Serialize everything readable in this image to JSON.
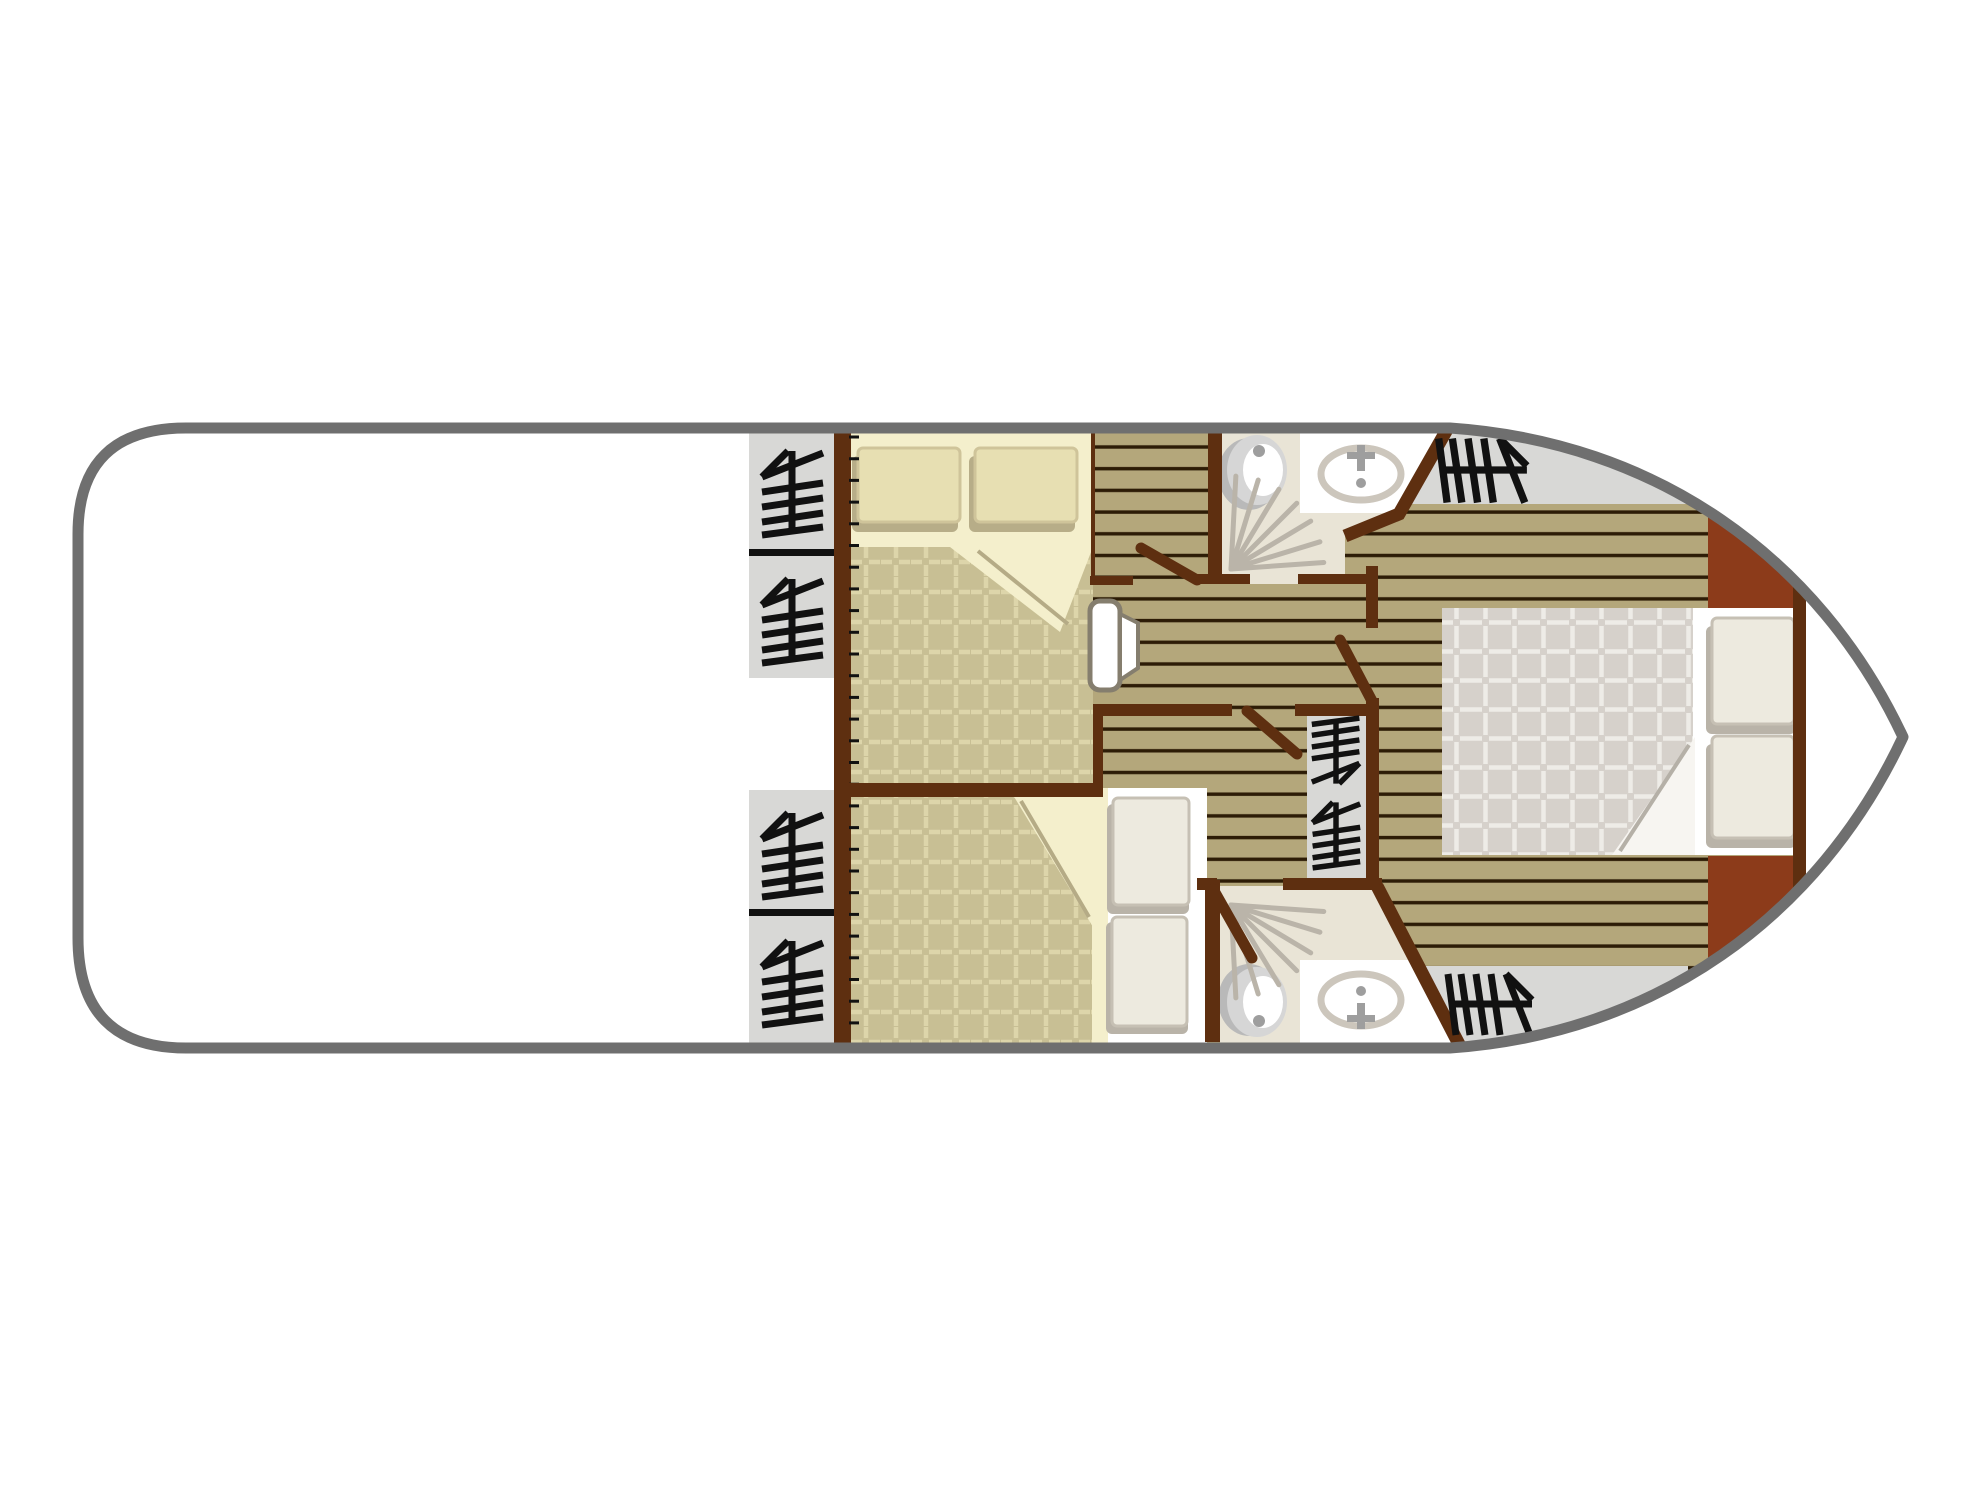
{
  "canvas": {
    "width": 1981,
    "height": 1485,
    "background": "#ffffff"
  },
  "plan": {
    "kind": "boat-deck-floor-plan",
    "rooms": [
      "aft-deck",
      "port-stairs",
      "cabin-top",
      "cabin-bottom",
      "corridor",
      "bathroom-top",
      "bathroom-bottom",
      "center-stair-well",
      "master-bow-cabin"
    ]
  },
  "palette": {
    "white": "#ffffff",
    "hull": "#6f6f6f",
    "wall": "#5e2f10",
    "rust": "#8c3b1a",
    "stairGray": "#d8d8d6",
    "glyph": "#111111",
    "plankBase": "#b4a77b",
    "plankLine": "#2d1c06",
    "cream": "#f4efcc",
    "quiltTan": "#c8bf94",
    "quiltTanLine": "#ddd5aa",
    "quiltGray": "#d6d1cb",
    "quiltGrayLine": "#eeece7",
    "bathFloor": "#e9e4d6",
    "fixture": "#ccc6bc",
    "fixtureDark": "#9e9e9e",
    "toiletShadow": "#b9b9b9",
    "toiletBody": "#d6d6d6",
    "showerRay": "#bab4a9",
    "pillowTan": "#e7dfb2",
    "pillowTanEdge": "#cfc49a",
    "pillowShadowTan": "#b7ad88",
    "pillowWhite": "#edeadf",
    "pillowWhiteEdge": "#c6c0b4",
    "pillowShadowGray": "#b9b3a8",
    "foldLine": "#b5ab86",
    "foldLineGray": "#b5b0a7",
    "doorEdge": "#857e6e"
  },
  "hull": {
    "path": "M1450,428 L186,428 Q78,428 78,534 L78,938 Q78,1048 186,1048 L1450,1048 C1655,1034 1818,918 1903,737 C1818,556 1655,442 1450,428 Z",
    "strokeWidth": 11
  },
  "patterns": [
    {
      "id": "planks",
      "type": "stripes",
      "w": 40,
      "h": 21.7,
      "x": 0,
      "y": 3,
      "base": "$plankBase",
      "line": "$plankLine",
      "lw": 3.4,
      "ly": 10
    },
    {
      "id": "quilt",
      "type": "grid",
      "w": 30,
      "h": 30,
      "x": 851,
      "y": 547,
      "base": "$quiltTan",
      "line": "$quiltTanLine",
      "lw": 4.5,
      "dash": "11 7"
    },
    {
      "id": "quiltM",
      "type": "grid",
      "w": 29,
      "h": 29,
      "x": 1442,
      "y": 608,
      "base": "$quiltGray",
      "line": "$quiltGrayLine",
      "lw": 4.5,
      "dash": "11 7"
    }
  ],
  "stairGlyph": {
    "strokes": [
      "M0,-38L0,42",
      "M-30,-12L31,-36",
      "M-30,-12L-4,-38",
      "M-30,3L31,-6",
      "M-30,18L31,9",
      "M-30,33L31,24",
      "M-30,46L31,38"
    ],
    "w": 7
  },
  "elements": [
    {
      "name": "floor-planks",
      "type": "rect",
      "x": 1085,
      "y": 424,
      "w": 830,
      "h": 628,
      "fill": "@planks"
    },
    {
      "name": "bow-stairs-top-area",
      "type": "rect",
      "x": 1408,
      "y": 424,
      "w": 292,
      "h": 80,
      "fill": "$stairGray"
    },
    {
      "name": "bow-stairs-bottom-area",
      "type": "rect",
      "x": 1418,
      "y": 966,
      "w": 270,
      "h": 86,
      "fill": "$stairGray"
    },
    {
      "name": "bow-cabinet-top",
      "type": "rect",
      "x": 1708,
      "y": 490,
      "w": 96,
      "h": 120,
      "fill": "$rust"
    },
    {
      "name": "bow-cabinet-bottom",
      "type": "rect",
      "x": 1708,
      "y": 856,
      "w": 96,
      "h": 120,
      "fill": "$rust"
    },
    {
      "name": "bow-tip-locker",
      "type": "rect",
      "x": 1806,
      "y": 424,
      "w": 112,
      "h": 628,
      "fill": "$white"
    },
    {
      "name": "cabin-top-sheet",
      "type": "rect",
      "x": 851,
      "y": 424,
      "w": 242,
      "h": 123,
      "fill": "$cream"
    },
    {
      "name": "cabin-top-quilt",
      "type": "rect",
      "x": 851,
      "y": 547,
      "w": 242,
      "h": 240,
      "fill": "@quilt"
    },
    {
      "name": "cabin-top-quilt-fold",
      "type": "polygon",
      "points": [
        950,
        547,
        1093,
        547,
        1060,
        632
      ],
      "fill": "$cream"
    },
    {
      "name": "cabin-top-fold-line",
      "type": "line",
      "x1": 978,
      "y1": 551,
      "x2": 1068,
      "y2": 624,
      "stroke": "$foldLine",
      "w": 4
    },
    {
      "name": "cabin-top-pillow-left-shadow",
      "type": "rect",
      "x": 852,
      "y": 456,
      "w": 106,
      "h": 76,
      "rx": 6,
      "fill": "$pillowShadowTan"
    },
    {
      "name": "cabin-top-pillow-left",
      "type": "rect",
      "x": 858,
      "y": 448,
      "w": 102,
      "h": 74,
      "rx": 5,
      "fill": "$pillowTan",
      "stroke": "$pillowTanEdge",
      "sw": 3
    },
    {
      "name": "cabin-top-pillow-right-shadow",
      "type": "rect",
      "x": 969,
      "y": 456,
      "w": 106,
      "h": 76,
      "rx": 6,
      "fill": "$pillowShadowTan"
    },
    {
      "name": "cabin-top-pillow-right",
      "type": "rect",
      "x": 975,
      "y": 448,
      "w": 102,
      "h": 74,
      "rx": 5,
      "fill": "$pillowTan",
      "stroke": "$pillowTanEdge",
      "sw": 3
    },
    {
      "name": "cabin-bottom-quilt",
      "type": "rect",
      "x": 851,
      "y": 795,
      "w": 242,
      "h": 253,
      "fill": "@quilt"
    },
    {
      "name": "cabin-bottom-quilt-fold",
      "type": "polygon",
      "points": [
        1013,
        795,
        1093,
        795,
        1093,
        927
      ],
      "fill": "$cream"
    },
    {
      "name": "cabin-bottom-fold-line",
      "type": "line",
      "x1": 1021,
      "y1": 801,
      "x2": 1089,
      "y2": 917,
      "stroke": "$foldLine",
      "w": 4
    },
    {
      "name": "cabin-bottom-sheet-strip",
      "type": "rect",
      "x": 1092,
      "y": 788,
      "w": 18,
      "h": 260,
      "fill": "$cream"
    },
    {
      "name": "cabin-bottom-bed-head",
      "type": "rect",
      "x": 1108,
      "y": 788,
      "w": 99,
      "h": 260,
      "fill": "$white"
    },
    {
      "name": "cabin-bottom-pillow-top-shadow",
      "type": "rect",
      "x": 1107,
      "y": 804,
      "w": 82,
      "h": 110,
      "rx": 6,
      "fill": "$pillowShadowGray"
    },
    {
      "name": "cabin-bottom-pillow-top",
      "type": "rect",
      "x": 1113,
      "y": 798,
      "w": 76,
      "h": 107,
      "rx": 5,
      "fill": "$pillowWhite",
      "stroke": "$pillowWhiteEdge",
      "sw": 3
    },
    {
      "name": "cabin-bottom-pillow-bottom-shadow",
      "type": "rect",
      "x": 1106,
      "y": 922,
      "w": 82,
      "h": 112,
      "rx": 6,
      "fill": "$pillowShadowGray"
    },
    {
      "name": "cabin-bottom-pillow-bottom",
      "type": "rect",
      "x": 1112,
      "y": 917,
      "w": 75,
      "h": 109,
      "rx": 5,
      "fill": "$pillowWhite",
      "stroke": "$pillowWhiteEdge",
      "sw": 3
    },
    {
      "name": "bathroom-top-floor",
      "type": "polygon",
      "points": [
        1222,
        424,
        1452,
        424,
        1447,
        437,
        1399,
        514,
        1345,
        536,
        1345,
        584,
        1222,
        584
      ],
      "fill": "$bathFloor"
    },
    {
      "name": "bathroom-bottom-floor",
      "type": "polygon",
      "points": [
        1220,
        886,
        1378,
        886,
        1460,
        1048,
        1220,
        1048
      ],
      "fill": "$bathFloor"
    },
    {
      "name": "bathroom-top-sink-counter",
      "type": "polygon",
      "points": [
        1300,
        424,
        1450,
        424,
        1444,
        441,
        1400,
        513,
        1300,
        513
      ],
      "fill": "$white"
    },
    {
      "name": "bathroom-top-sink-basin",
      "type": "ellipse",
      "cx": 1361,
      "cy": 474,
      "rx": 40,
      "ry": 26,
      "fill": "$white",
      "stroke": "$fixture",
      "sw": 7
    },
    {
      "name": "bathroom-top-tap-stem",
      "type": "rect",
      "x": 1357,
      "y": 445,
      "w": 8,
      "h": 26,
      "fill": "$fixtureDark"
    },
    {
      "name": "bathroom-top-tap-cross",
      "type": "rect",
      "x": 1347,
      "y": 452,
      "w": 28,
      "h": 7,
      "fill": "$fixtureDark"
    },
    {
      "name": "bathroom-top-tap-dot",
      "type": "circle",
      "cx": 1361,
      "cy": 483,
      "r": 5,
      "fill": "$fixtureDark"
    },
    {
      "name": "bathroom-top-toilet-shadow",
      "type": "ellipse",
      "cx": 1249,
      "cy": 474,
      "rx": 31,
      "ry": 36,
      "fill": "$toiletShadow"
    },
    {
      "name": "bathroom-top-toilet",
      "type": "ellipse",
      "cx": 1257,
      "cy": 470,
      "rx": 30,
      "ry": 35,
      "fill": "$toiletBody"
    },
    {
      "name": "bathroom-top-toilet-seat",
      "type": "ellipse",
      "cx": 1263,
      "cy": 470,
      "rx": 20,
      "ry": 26,
      "fill": "$white"
    },
    {
      "name": "bathroom-top-toilet-button",
      "type": "circle",
      "cx": 1259,
      "cy": 451,
      "r": 6,
      "fill": "$fixtureDark"
    },
    {
      "name": "bathroom-top-shower-spray",
      "type": "rays",
      "cx": 1231,
      "cy": 569,
      "len": 93,
      "angles": [
        -87,
        -73,
        -59,
        -45,
        -31,
        -17,
        -4
      ],
      "stroke": "$showerRay",
      "w": 5
    },
    {
      "name": "bathroom-top-shower-drain",
      "type": "circle",
      "cx": 1238,
      "cy": 561,
      "r": 8,
      "fill": "$showerRay"
    },
    {
      "name": "bathroom-bottom-sink-counter",
      "type": "polygon",
      "points": [
        1300,
        960,
        1416,
        960,
        1458,
        1048,
        1300,
        1048
      ],
      "fill": "$white"
    },
    {
      "name": "bathroom-bottom-sink-basin",
      "type": "ellipse",
      "cx": 1361,
      "cy": 1000,
      "rx": 40,
      "ry": 26,
      "fill": "$white",
      "stroke": "$fixture",
      "sw": 7
    },
    {
      "name": "bathroom-bottom-tap-stem",
      "type": "rect",
      "x": 1357,
      "y": 1003,
      "w": 8,
      "h": 26,
      "fill": "$fixtureDark"
    },
    {
      "name": "bathroom-bottom-tap-cross",
      "type": "rect",
      "x": 1347,
      "y": 1015,
      "w": 28,
      "h": 7,
      "fill": "$fixtureDark"
    },
    {
      "name": "bathroom-bottom-tap-dot",
      "type": "circle",
      "cx": 1361,
      "cy": 991,
      "r": 5,
      "fill": "$fixtureDark"
    },
    {
      "name": "bathroom-bottom-toilet-shadow",
      "type": "ellipse",
      "cx": 1249,
      "cy": 1000,
      "rx": 31,
      "ry": 36,
      "fill": "$toiletShadow"
    },
    {
      "name": "bathroom-bottom-toilet",
      "type": "ellipse",
      "cx": 1257,
      "cy": 1002,
      "rx": 30,
      "ry": 35,
      "fill": "$toiletBody"
    },
    {
      "name": "bathroom-bottom-toilet-seat",
      "type": "ellipse",
      "cx": 1263,
      "cy": 1002,
      "rx": 20,
      "ry": 26,
      "fill": "$white"
    },
    {
      "name": "bathroom-bottom-toilet-button",
      "type": "circle",
      "cx": 1259,
      "cy": 1021,
      "r": 6,
      "fill": "$fixtureDark"
    },
    {
      "name": "bathroom-bottom-shower-spray",
      "type": "rays",
      "cx": 1231,
      "cy": 905,
      "len": 93,
      "angles": [
        87,
        73,
        59,
        45,
        31,
        17,
        4
      ],
      "stroke": "$showerRay",
      "w": 5
    },
    {
      "name": "bathroom-bottom-shower-drain",
      "type": "circle",
      "cx": 1238,
      "cy": 913,
      "r": 8,
      "fill": "$showerRay"
    },
    {
      "name": "stairs-port-top-1",
      "type": "rect",
      "x": 749,
      "y": 424,
      "w": 86,
      "h": 127,
      "fill": "$stairGray"
    },
    {
      "name": "stairs-port-top-2",
      "type": "rect",
      "x": 749,
      "y": 555,
      "w": 86,
      "h": 123,
      "fill": "$stairGray"
    },
    {
      "name": "stairs-port-top-divider",
      "type": "rect",
      "x": 749,
      "y": 549,
      "w": 86,
      "h": 7,
      "fill": "$glyph"
    },
    {
      "name": "stairs-port-bottom-1",
      "type": "rect",
      "x": 749,
      "y": 790,
      "w": 86,
      "h": 121,
      "fill": "$stairGray"
    },
    {
      "name": "stairs-port-bottom-2",
      "type": "rect",
      "x": 749,
      "y": 915,
      "w": 86,
      "h": 133,
      "fill": "$stairGray"
    },
    {
      "name": "stairs-port-bottom-divider",
      "type": "rect",
      "x": 749,
      "y": 909,
      "w": 86,
      "h": 7,
      "fill": "$glyph"
    },
    {
      "name": "stairs-center-well",
      "type": "rect",
      "x": 1307,
      "y": 712,
      "w": 59,
      "h": 168,
      "fill": "$stairGray"
    },
    {
      "name": "master-bed-quilt",
      "type": "rect",
      "x": 1442,
      "y": 608,
      "w": 251,
      "h": 247,
      "fill": "@quiltM"
    },
    {
      "name": "master-bed-sheet",
      "type": "rect",
      "x": 1693,
      "y": 608,
      "w": 100,
      "h": 247,
      "fill": "$white"
    },
    {
      "name": "master-bed-fold",
      "type": "polygon",
      "points": [
        1695,
        737,
        1695,
        855,
        1612,
        855
      ],
      "fill": "#f7f5f1"
    },
    {
      "name": "master-bed-fold-line",
      "type": "line",
      "x1": 1689,
      "y1": 745,
      "x2": 1620,
      "y2": 851,
      "stroke": "$foldLineGray",
      "w": 4
    },
    {
      "name": "master-pillow-top-shadow",
      "type": "rect",
      "x": 1706,
      "y": 626,
      "w": 90,
      "h": 108,
      "rx": 6,
      "fill": "$pillowShadowGray"
    },
    {
      "name": "master-pillow-top",
      "type": "rect",
      "x": 1712,
      "y": 618,
      "w": 82,
      "h": 106,
      "rx": 5,
      "fill": "$pillowWhite",
      "stroke": "$pillowWhiteEdge",
      "sw": 3
    },
    {
      "name": "master-pillow-bottom-shadow",
      "type": "rect",
      "x": 1706,
      "y": 744,
      "w": 90,
      "h": 104,
      "rx": 6,
      "fill": "$pillowShadowGray"
    },
    {
      "name": "master-pillow-bottom",
      "type": "rect",
      "x": 1712,
      "y": 736,
      "w": 82,
      "h": 102,
      "rx": 5,
      "fill": "$pillowWhite",
      "stroke": "$pillowWhiteEdge",
      "sw": 3
    },
    {
      "name": "wall-cabins-left",
      "type": "rect",
      "x": 834,
      "y": 424,
      "w": 17,
      "h": 628,
      "fill": "$wall"
    },
    {
      "name": "wall-plank-ticks",
      "type": "vticks",
      "x1": 849,
      "x2": 859,
      "y0": 437,
      "step": 21.7,
      "count": 28,
      "stroke": "$glyph",
      "w": 3
    },
    {
      "name": "wall-cabin-divider",
      "type": "rect",
      "x": 834,
      "y": 783,
      "w": 269,
      "h": 14,
      "fill": "$wall"
    },
    {
      "name": "wall-corridor-south-left",
      "type": "rect",
      "x": 1093,
      "y": 704,
      "w": 139,
      "h": 12,
      "fill": "$wall"
    },
    {
      "name": "wall-corridor-south-right",
      "type": "rect",
      "x": 1295,
      "y": 704,
      "w": 80,
      "h": 12,
      "fill": "$wall"
    },
    {
      "name": "wall-corridor-connector",
      "type": "rect",
      "x": 1093,
      "y": 704,
      "w": 10,
      "h": 90,
      "fill": "$wall"
    },
    {
      "name": "wall-cabin-top-door-stub",
      "type": "rect",
      "x": 1090,
      "y": 576,
      "w": 43,
      "h": 9,
      "fill": "$wall"
    },
    {
      "name": "wall-cabin-top-edge",
      "type": "rect",
      "x": 1091,
      "y": 424,
      "w": 4,
      "h": 154,
      "fill": "$wall"
    },
    {
      "name": "wall-bathroom-top-left",
      "type": "rect",
      "x": 1208,
      "y": 424,
      "w": 14,
      "h": 160,
      "fill": "$wall"
    },
    {
      "name": "wall-bathroom-top-south-left",
      "type": "rect",
      "x": 1197,
      "y": 574,
      "w": 53,
      "h": 10,
      "fill": "$wall"
    },
    {
      "name": "wall-bathroom-top-south-right",
      "type": "rect",
      "x": 1298,
      "y": 574,
      "w": 74,
      "h": 10,
      "fill": "$wall"
    },
    {
      "name": "wall-master-door-jamb",
      "type": "rect",
      "x": 1366,
      "y": 566,
      "w": 12,
      "h": 62,
      "fill": "$wall"
    },
    {
      "name": "wall-bathroom-top-angled",
      "type": "polyline",
      "points": [
        1449,
        426,
        1399,
        514,
        1345,
        536
      ],
      "stroke": "$wall",
      "w": 13
    },
    {
      "name": "wall-bathroom-bottom-left",
      "type": "rect",
      "x": 1205,
      "y": 880,
      "w": 15,
      "h": 162,
      "fill": "$wall"
    },
    {
      "name": "wall-bathroom-bottom-north-left",
      "type": "rect",
      "x": 1197,
      "y": 878,
      "w": 20,
      "h": 12,
      "fill": "$wall"
    },
    {
      "name": "wall-bathroom-bottom-north-right",
      "type": "rect",
      "x": 1283,
      "y": 878,
      "w": 99,
      "h": 12,
      "fill": "$wall"
    },
    {
      "name": "wall-bathroom-bottom-angled",
      "type": "line",
      "x1": 1377,
      "y1": 886,
      "x2": 1462,
      "y2": 1050,
      "stroke": "$wall",
      "w": 13
    },
    {
      "name": "wall-stairs-center-east",
      "type": "rect",
      "x": 1366,
      "y": 698,
      "w": 13,
      "h": 192,
      "fill": "$wall"
    },
    {
      "name": "wall-master-headboard",
      "type": "rect",
      "x": 1793,
      "y": 578,
      "w": 13,
      "h": 319,
      "fill": "$wall"
    },
    {
      "name": "door-bathroom-top-leaf",
      "type": "line",
      "x1": 1197,
      "y1": 580,
      "x2": 1141,
      "y2": 548,
      "stroke": "$wall",
      "w": 11,
      "cap": "round"
    },
    {
      "name": "door-master-leaf",
      "type": "line",
      "x1": 1372,
      "y1": 701,
      "x2": 1340,
      "y2": 640,
      "stroke": "$wall",
      "w": 11,
      "cap": "round"
    },
    {
      "name": "door-corridor-leaf",
      "type": "line",
      "x1": 1247,
      "y1": 711,
      "x2": 1297,
      "y2": 754,
      "stroke": "$wall",
      "w": 11,
      "cap": "round"
    },
    {
      "name": "door-bathroom-bottom-leaf",
      "type": "line",
      "x1": 1213,
      "y1": 889,
      "x2": 1252,
      "y2": 958,
      "stroke": "$wall",
      "w": 11,
      "cap": "round"
    },
    {
      "name": "door-cabin-top-panel",
      "type": "rect",
      "x": 1090,
      "y": 601,
      "w": 30,
      "h": 89,
      "rx": 10,
      "fill": "$white",
      "stroke": "$doorEdge",
      "sw": 5
    },
    {
      "name": "door-cabin-top-panel-fold",
      "type": "polygon",
      "points": [
        1120,
        614,
        1138,
        623,
        1138,
        668,
        1120,
        680
      ],
      "fill": "$white",
      "stroke": "$doorEdge",
      "sw": 4
    },
    {
      "name": "stairs-glyph-port-top-1",
      "type": "glyph",
      "cx": 792,
      "cy": 489,
      "s": 1,
      "r": 0
    },
    {
      "name": "stairs-glyph-port-top-2",
      "type": "glyph",
      "cx": 792,
      "cy": 617,
      "s": 1,
      "r": 0
    },
    {
      "name": "stairs-glyph-port-bottom-1",
      "type": "glyph",
      "cx": 792,
      "cy": 851,
      "s": 1,
      "r": 0
    },
    {
      "name": "stairs-glyph-port-bottom-2",
      "type": "glyph",
      "cx": 792,
      "cy": 979,
      "s": 1,
      "r": 0
    },
    {
      "name": "stairs-glyph-center-1",
      "type": "glyph",
      "cx": 1336,
      "cy": 754,
      "s": 0.78,
      "r": 180
    },
    {
      "name": "stairs-glyph-center-2",
      "type": "glyph",
      "cx": 1336,
      "cy": 832,
      "s": 0.78,
      "r": 0
    },
    {
      "name": "stairs-glyph-bow-top",
      "type": "glyph",
      "cx": 1487,
      "cy": 470,
      "s": 1.05,
      "r": 90
    },
    {
      "name": "stairs-glyph-bow-bottom",
      "type": "glyph",
      "cx": 1494,
      "cy": 1004,
      "s": 1,
      "r": 90
    }
  ]
}
